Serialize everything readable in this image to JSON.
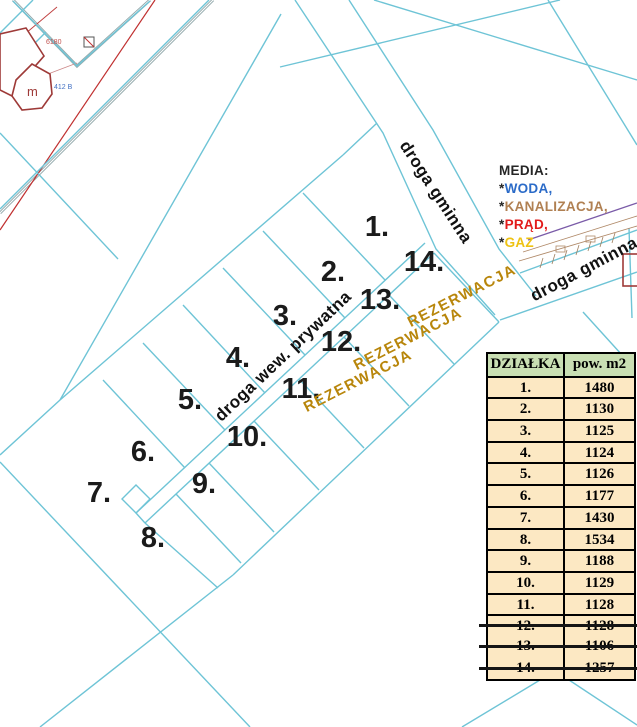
{
  "map": {
    "plot_labels": [
      "1.",
      "2.",
      "3.",
      "4.",
      "5.",
      "6.",
      "7.",
      "8.",
      "9.",
      "10.",
      "11.",
      "12.",
      "13.",
      "14."
    ],
    "rezerwacja_labels": [
      "REZERWACJA",
      "REZERWACJA",
      "REZERWACJA"
    ],
    "roads": {
      "gminna_top": "droga gminna",
      "gminna_right": "droga gminna",
      "private": "droga wew. prywatna"
    },
    "annotations": {
      "building_label": "m",
      "plot_ref_small": "412 B",
      "parcel_no_small": "6180"
    },
    "colors": {
      "parcel_line": "#6ec4d6",
      "rezerwacja": "#b8860b",
      "road_gray": "#93a9ac",
      "cadastral_red": "#9e3a38",
      "power_line_red": "#c03030",
      "utility_purple": "#7a5ba8"
    }
  },
  "media": {
    "title": "MEDIA:",
    "items": [
      {
        "bullet": "*",
        "label": "WODA,",
        "color": "#2b6bc8"
      },
      {
        "bullet": "*",
        "label": "KANALIZACJA,",
        "color": "#b08052"
      },
      {
        "bullet": "*",
        "label": "PRĄD,",
        "color": "#e21b1b"
      },
      {
        "bullet": "*",
        "label": "GAZ",
        "color": "#eec213"
      }
    ]
  },
  "table": {
    "headers": [
      "DZIAŁKA",
      "pow. m2"
    ],
    "rows": [
      {
        "no": "1.",
        "area": "1480",
        "struck": false
      },
      {
        "no": "2.",
        "area": "1130",
        "struck": false
      },
      {
        "no": "3.",
        "area": "1125",
        "struck": false
      },
      {
        "no": "4.",
        "area": "1124",
        "struck": false
      },
      {
        "no": "5.",
        "area": "1126",
        "struck": false
      },
      {
        "no": "6.",
        "area": "1177",
        "struck": false
      },
      {
        "no": "7.",
        "area": "1430",
        "struck": false
      },
      {
        "no": "8.",
        "area": "1534",
        "struck": false
      },
      {
        "no": "9.",
        "area": "1188",
        "struck": false
      },
      {
        "no": "10.",
        "area": "1129",
        "struck": false
      },
      {
        "no": "11.",
        "area": "1128",
        "struck": false
      },
      {
        "no": "12.",
        "area": "1128",
        "struck": true
      },
      {
        "no": "13.",
        "area": "1106",
        "struck": true
      },
      {
        "no": "14.",
        "area": "1257",
        "struck": true
      }
    ]
  }
}
